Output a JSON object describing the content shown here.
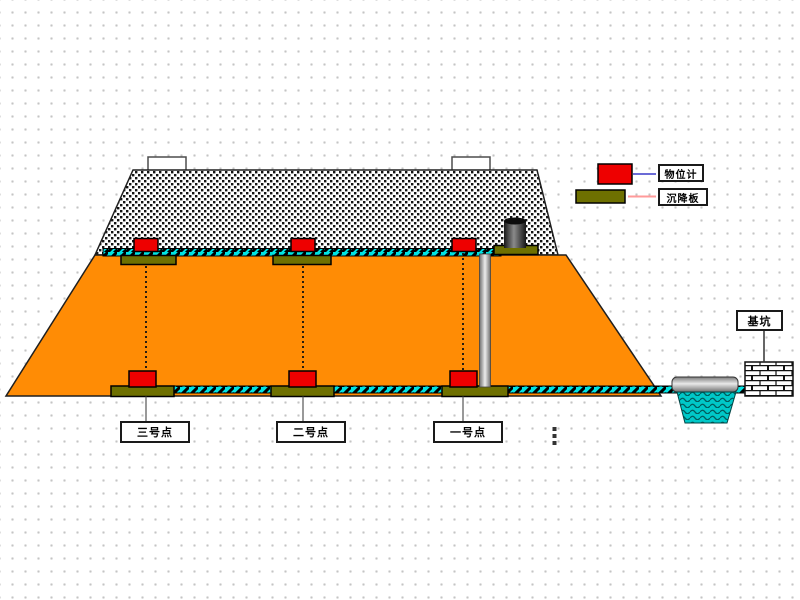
{
  "legend": {
    "items": [
      {
        "id": "level-gauge",
        "label": "物位计",
        "swatch": "red-sensor",
        "line_color": "#6b6bd6"
      },
      {
        "id": "settlement-plate",
        "label": "沉降板",
        "swatch": "olive-plate",
        "line_color": "#ff9a9a"
      }
    ]
  },
  "points": [
    {
      "label": "三号点"
    },
    {
      "label": "二号点"
    },
    {
      "label": "一号点"
    }
  ],
  "pit_label": "基坑",
  "colors": {
    "embankment_fill": "#ff8c05",
    "band_cyan": "#00e3e3",
    "plate_olive": "#6e7000",
    "sensor_red": "#ee0000",
    "pool_teal": "#00c8c8",
    "legend_line_blue": "#6b6bd6",
    "legend_line_pink": "#ff9a9a",
    "grid_dot": "#c4c4c4",
    "outline": "#1f1f1f"
  }
}
